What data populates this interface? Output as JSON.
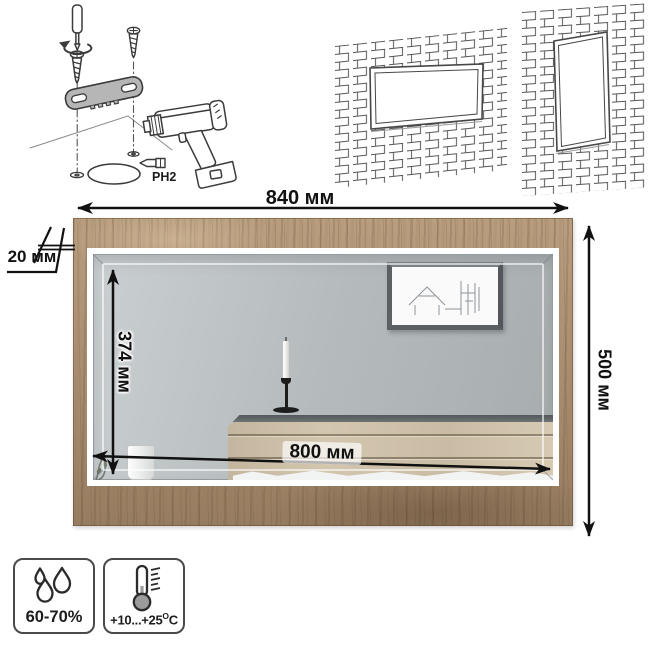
{
  "installation": {
    "bit_label": "PH2"
  },
  "dimensions": {
    "outer_width": "840 мм",
    "outer_height": "500 мм",
    "inner_width": "800 мм",
    "inner_height": "374 мм",
    "frame_depth": "20 мм"
  },
  "environment": {
    "humidity_range": "60-70%",
    "temperature_prefix": "+10...+25",
    "temperature_degree": "O",
    "temperature_unit": "C"
  },
  "icons": {
    "humidity": "water-drops-icon",
    "temperature": "thermometer-icon",
    "installation_tools": [
      "screwdriver-icon",
      "rotation-arrow-icon",
      "screw-icon",
      "mounting-bracket-icon",
      "drill-icon",
      "drill-bit-icon"
    ]
  },
  "colors": {
    "frame_wood": "#ac9072",
    "mirror_glass": "#b5bbbd",
    "line_art": "#3b3b3b",
    "dimension": "#111111"
  }
}
